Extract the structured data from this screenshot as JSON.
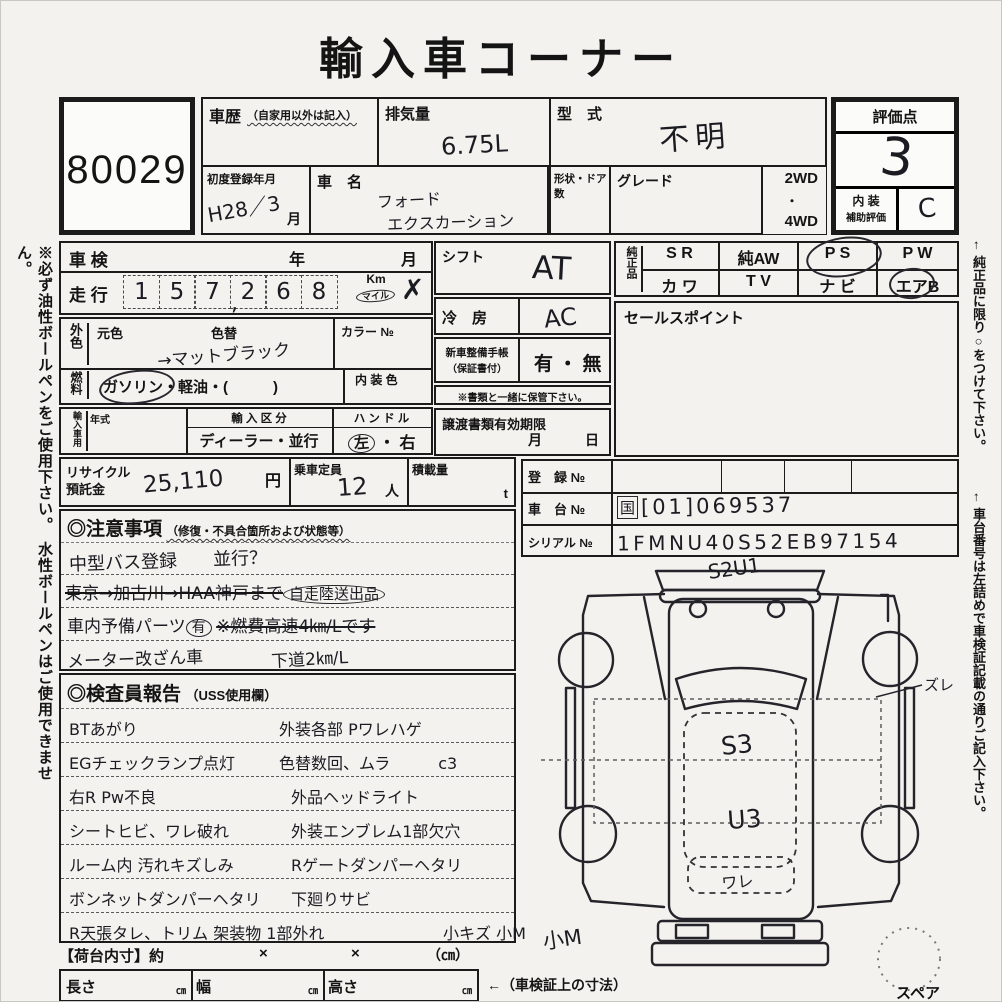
{
  "title": "輸入車コーナー",
  "lot_number": "80029",
  "side_notes": {
    "left": "※必ず油性ボールペンをご使用下さい。　水性ボールペンはご使用できません。",
    "right_top": "← 純正品に限り○をつけて下さい。",
    "right_bottom": "← 車台番号は左詰めで車検証記載の通りご記入下さい。"
  },
  "top_grid": {
    "history_label": "車歴",
    "history_note": "（自家用以外は記入）",
    "displacement_label": "排気量",
    "displacement_value": "6.75L",
    "model_label": "型　式",
    "model_value": "不明",
    "first_reg_label": "初度登録年月",
    "first_reg_value": "H28／3",
    "first_reg_month": "月",
    "name_label": "車　名",
    "name_line1": "フォード",
    "name_line2": "エクスカーション",
    "shape_label": "形状・ドア数",
    "grade_label": "グレード",
    "wd2": "2WD",
    "dot": "・",
    "wd4": "4WD"
  },
  "score_box": {
    "label": "評価点",
    "value": "3",
    "interior_label": "内 装",
    "aux_label": "補助評価",
    "interior_value": "C"
  },
  "vehicle": {
    "shaken_label": "車 検",
    "year": "年",
    "month": "月",
    "mileage_label": "走 行",
    "digits": [
      "1",
      "5",
      "7",
      "2",
      "6",
      "8"
    ],
    "comma": ",",
    "km": "Km",
    "mile": "マイル",
    "cross": "✗",
    "ext_label": "外色",
    "orig_color": "元色",
    "repaint": "色替",
    "repaint_value": "→マットブラック",
    "color_no": "カラー №",
    "fuel_label": "燃料",
    "fuel_value": "ガソリン・軽油・(　　　)",
    "interior_color": "内 装 色",
    "import_label": "輸入車用",
    "year_model": "年式",
    "import_class": "輸 入 区 分",
    "import_value": "ディーラー・並行",
    "handle": "ハ ン ド ル",
    "handle_left": "左",
    "handle_dot": "・",
    "handle_right": "右"
  },
  "mid_column": {
    "shift_label": "シフト",
    "shift_value": "AT",
    "cool_label": "冷　房",
    "cool_value": "AC",
    "book_label1": "新車整備手帳",
    "book_label2": "（保証書付）",
    "book_value": "有 ・ 無",
    "keep_note": "※書類と一緒に保管下さい。",
    "transfer_label": "譲渡書類有効期限",
    "transfer_month": "月",
    "transfer_day": "日"
  },
  "genuine": {
    "label": "純正品",
    "sr": "S R",
    "aw": "純AW",
    "ps": "P S",
    "pw": "P W",
    "kawa": "カ ワ",
    "tv": "T V",
    "navi": "ナ ビ",
    "airb": "エアB"
  },
  "sales": {
    "label": "セールスポイント"
  },
  "recycle": {
    "label1": "リサイクル",
    "label2": "預託金",
    "value": "25,110",
    "unit": "円",
    "capacity_label": "乗車定員",
    "capacity_value": "12",
    "capacity_unit": "人",
    "load_label": "積載量",
    "load_unit": "t"
  },
  "registration": {
    "reg_label": "登　録 №",
    "chassis_label": "車　台 №",
    "chassis_prefix": "国",
    "chassis_value": "[01]069537",
    "serial_label": "シリアル №",
    "serial_value": "1FMNU40S52EB97154"
  },
  "cautions": {
    "header": "◎注意事項",
    "header_note": "（修復・不具合箇所および状態等）",
    "line1": "中型バス登録　　並行？",
    "line2": "東京→加古川→HAA神戸まで",
    "line2_circled": "自走陸送出品",
    "line3": "車内予備パーツ",
    "line3_circled": "有",
    "line3b": "※燃費高速4㎞/Lです",
    "line4": "メーター改ざん車",
    "line4b": "下道2㎞/L"
  },
  "report": {
    "header": "◎検査員報告",
    "header_note": "（USS使用欄）",
    "left_lines": [
      "BTあがり",
      "EGチェックランプ点灯",
      "右R Pw不良",
      "シートヒビ、ワレ破れ",
      "ルーム内 汚れキズしみ",
      "ボンネットダンパーヘタリ",
      "R天張タレ、トリム 架装物 1部外れ"
    ],
    "right_lines": [
      "外装各部 Pワレハゲ",
      "色替数回、ムラ　　　c3",
      "外品ヘッドライト",
      "外装エンブレム1部欠穴",
      "Rゲートダンパーヘタリ",
      "下廻りサビ",
      "小キズ 小M"
    ]
  },
  "diagram": {
    "top_mark": "S2U1",
    "s3": "S3",
    "u3": "U3",
    "ware": "ワレ",
    "zure": "ズレ",
    "kom": "小M",
    "spare": "スペア"
  },
  "bottom": {
    "inner_label": "【荷台内寸】約",
    "x1": "×",
    "x2": "×",
    "cm_note": "（㎝）",
    "length": "長さ",
    "width": "幅",
    "height": "高さ",
    "cm": "㎝",
    "arrow_note": "←（車検証上の寸法）"
  }
}
